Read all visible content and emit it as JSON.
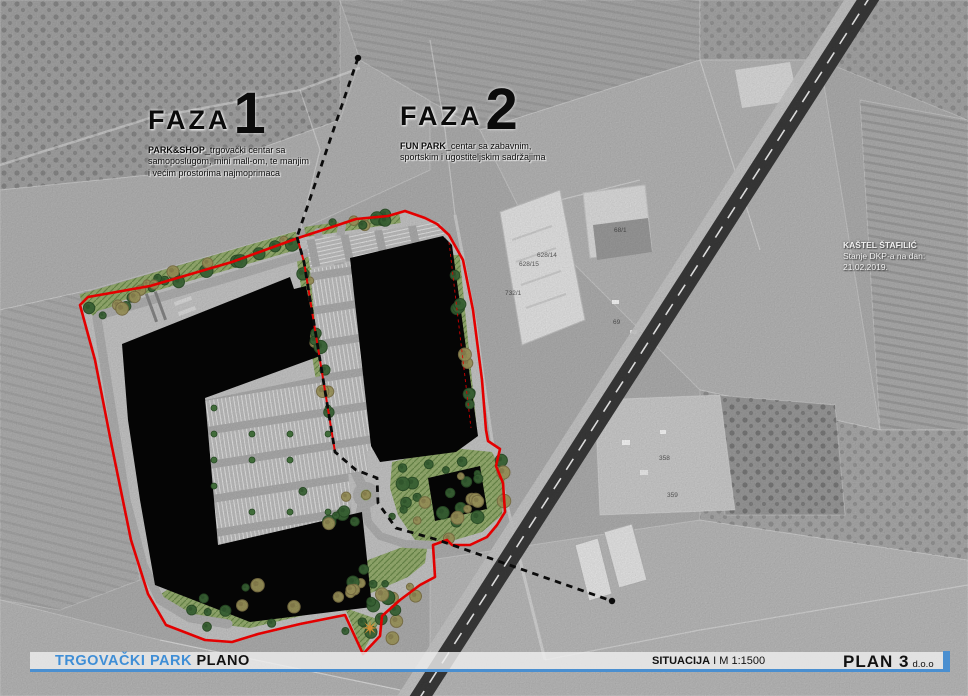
{
  "phases": [
    {
      "label": "FAZA",
      "number": "1",
      "lead": "PARK&SHOP",
      "desc": "_trgovački centar sa samoposlugom, mini mall-om, te manjim i većim prostorima najmoprimaca"
    },
    {
      "label": "FAZA",
      "number": "2",
      "lead": "FUN PARK",
      "desc": "_centar sa zabavnim, sportskim i ugostiteljskim sadržajima"
    }
  ],
  "note": {
    "line1": "KAŠTEL ŠTAFILIĆ",
    "line2": "Stanje DKP-a na dan:",
    "line3": "21.02.2019."
  },
  "footer": {
    "project": "TRGOVAČKI PARK",
    "project2": "PLANO",
    "drawing": "SITUACIJA",
    "scale": "I M 1:1500",
    "company": "PLAN 3",
    "company_suffix": "d.o.o"
  },
  "parcel_labels": [
    {
      "text": "628/14",
      "x": 537,
      "y": 257
    },
    {
      "text": "628/15",
      "x": 519,
      "y": 266
    },
    {
      "text": "68/1",
      "x": 614,
      "y": 232
    },
    {
      "text": "732/1",
      "x": 505,
      "y": 295
    },
    {
      "text": "69",
      "x": 613,
      "y": 324
    },
    {
      "text": "358",
      "x": 659,
      "y": 460
    },
    {
      "text": "359",
      "x": 667,
      "y": 497
    }
  ],
  "colors": {
    "red": "#ff0000",
    "blue": "#4a8fd0",
    "band": "#ededed",
    "treeGreen": "#3e6b39",
    "treeGreenDark": "#2c5229",
    "olive": "#a59d60",
    "oliveDark": "#837749",
    "lawn": "#9cb474",
    "hatchLine": "#70904e",
    "pavement": "#cccccc",
    "road": "#b6b6b6",
    "building": "#060606",
    "rail": "#3b3b3b",
    "star": "#f4a13b"
  }
}
